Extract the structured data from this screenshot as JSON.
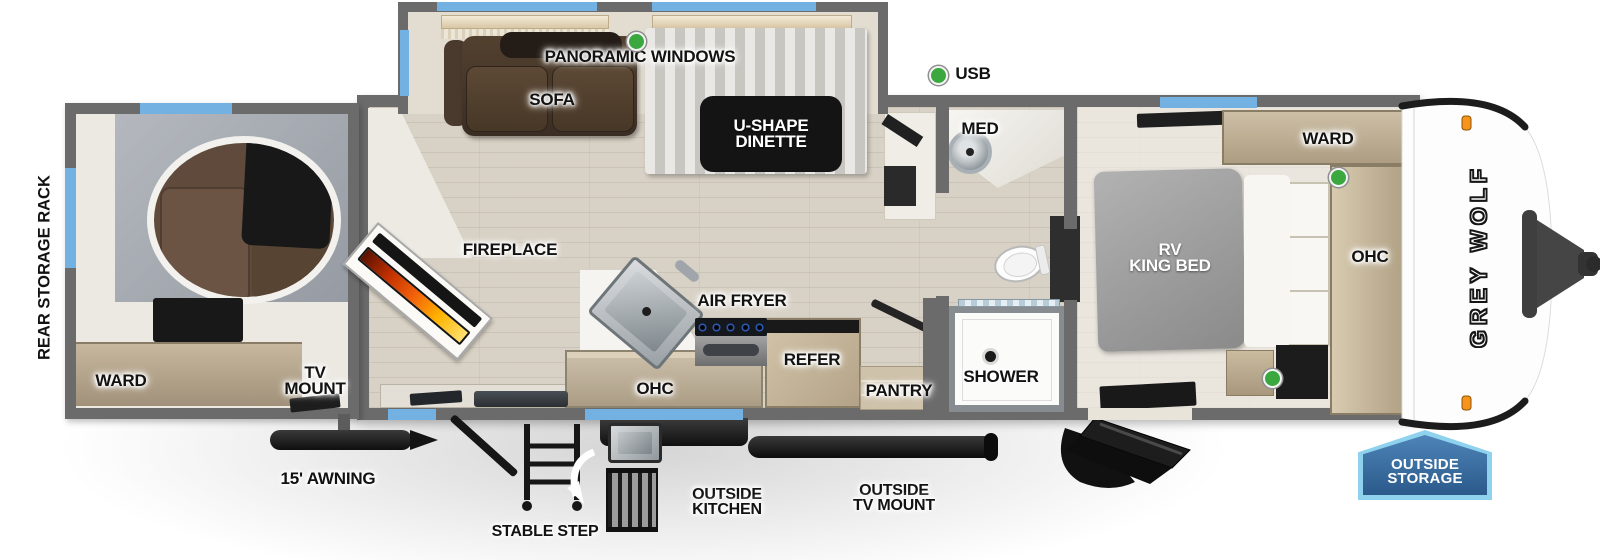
{
  "brand": "GREY WOLF",
  "legend": {
    "usb": "USB",
    "panoramic_windows": "PANORAMIC WINDOWS"
  },
  "garage": {
    "rear_storage_rack": "REAR STORAGE RACK",
    "ward": "WARD",
    "tv_mount": "TV\nMOUNT"
  },
  "living": {
    "sofa": "SOFA",
    "dinette": "U-SHAPE\nDINETTE",
    "fireplace": "FIREPLACE"
  },
  "kitchen": {
    "air_fryer": "AIR FRYER",
    "ohc": "OHC",
    "refer": "REFER",
    "pantry": "PANTRY"
  },
  "bath": {
    "med": "MED",
    "shower": "SHOWER"
  },
  "bedroom": {
    "ward": "WARD",
    "bed": "RV\nKING BED",
    "ohc": "OHC"
  },
  "exterior": {
    "awning": "15' AWNING",
    "stable_step": "STABLE STEP",
    "outside_kitchen": "OUTSIDE\nKITCHEN",
    "outside_tv_mount": "OUTSIDE\nTV MOUNT",
    "outside_storage": "OUTSIDE\nSTORAGE"
  },
  "colors": {
    "wall": "#6b6b6b",
    "window_blue": "#74b1e3",
    "usb_green": "#3aa83f",
    "badge_blue": "#2b5a8b",
    "badge_border": "#8ed2ee",
    "flame_orange": "#f2610b",
    "marker_orange": "#f7941d",
    "floor_wood": "#d8d1c5"
  }
}
